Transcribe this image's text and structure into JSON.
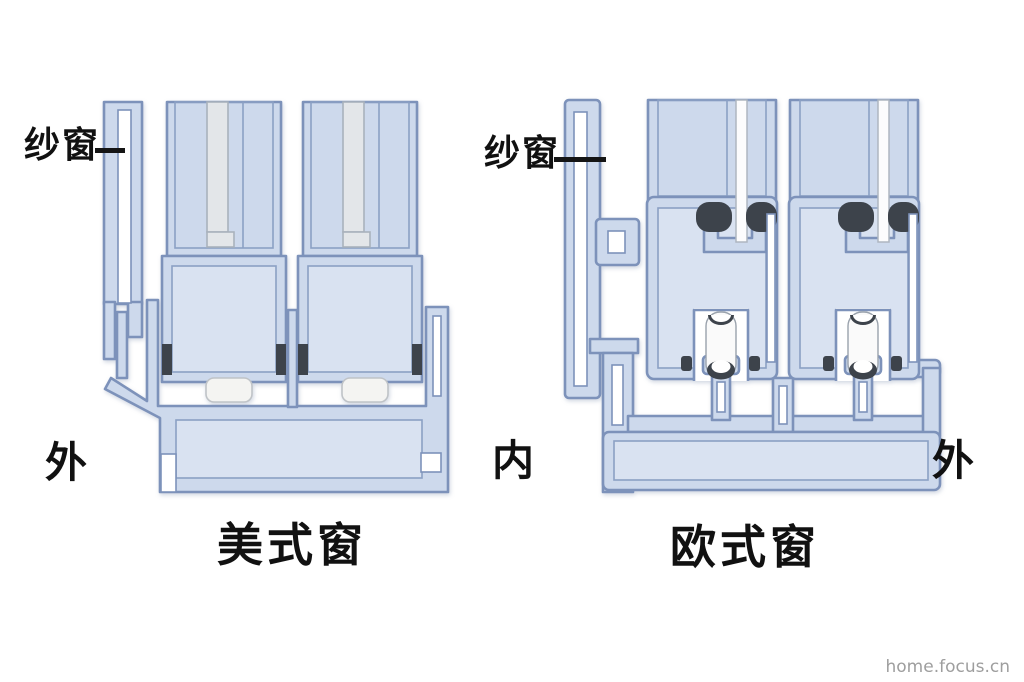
{
  "page": {
    "background": "#ffffff",
    "watermark": "home.focus.cn"
  },
  "colors": {
    "profile_fill": "#cdd9ec",
    "profile_inner_fill": "#d9e2f1",
    "outline": "#7d92ba",
    "glass_american": "#e3e6e9",
    "glass_european": "#fcfcfd",
    "seal_dark": "#3d434b",
    "glide_white": "#f4f4f2",
    "label_text": "#111111",
    "watermark_text": "#9e9e9e"
  },
  "american": {
    "caption": "美式窗",
    "screen_label": "纱窗",
    "outside_label": "外"
  },
  "european": {
    "caption": "欧式窗",
    "screen_label": "纱窗",
    "inside_label": "内",
    "outside_label": "外"
  }
}
